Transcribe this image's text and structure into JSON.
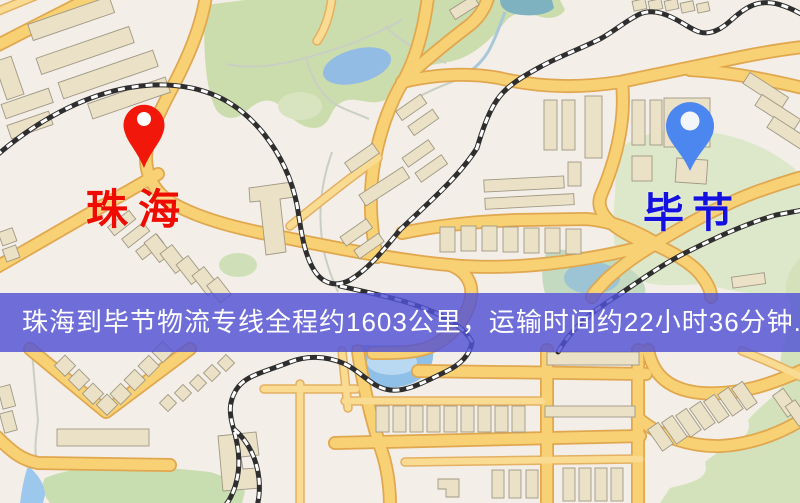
{
  "banner": {
    "text": "珠海到毕节物流专线全程约1603公里，运输时间约22小时36分钟.",
    "background_color": "#5252d5",
    "text_color": "#ffffff"
  },
  "origin": {
    "name": "珠海",
    "label_color": "#ee0b00",
    "marker_icon": "red-location-pin",
    "marker_color": "#f2170b"
  },
  "destination": {
    "name": "毕节",
    "label_color": "#1410df",
    "marker_icon": "blue-location-pin",
    "marker_color": "#4c86ef"
  },
  "route": {
    "distance_km": 1603,
    "duration_hours": 22,
    "duration_minutes": 36
  },
  "map_style": {
    "background": "#f3eee7",
    "road_fill": "#f8d175",
    "road_casing": "#e0a74f",
    "building_fill": "#eae1c7",
    "green_area": "#ccddad",
    "water": "#93bce4",
    "railway_dark": "#2e2e2e"
  }
}
